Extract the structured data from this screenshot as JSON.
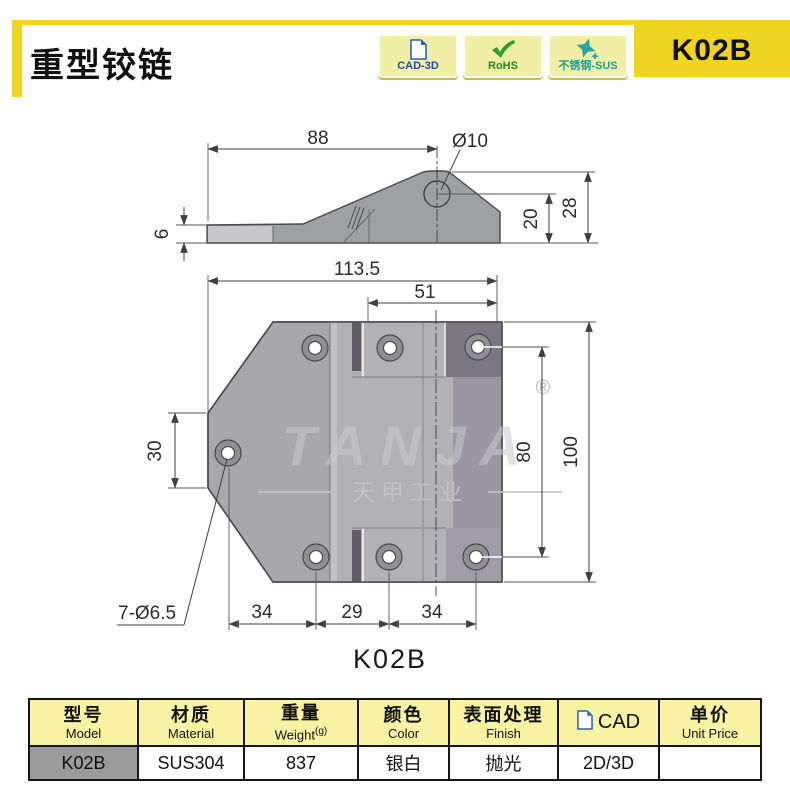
{
  "header": {
    "title": "重型铰链",
    "model_code": "K02B",
    "accent_yellow": "#f0d520",
    "badges": [
      {
        "label": "CAD-3D",
        "icon": "cad-document-icon",
        "color": "#1a4e9e"
      },
      {
        "label": "RoHS",
        "icon": "check-icon",
        "color": "#1e8c28"
      },
      {
        "label": "不锈钢-SUS",
        "icon": "sparkle-star-icon",
        "color": "#18a098"
      }
    ]
  },
  "drawing": {
    "side_view": {
      "length": "88",
      "hole_dia": "Ø10",
      "thickness": "6",
      "hole_center_height": "20",
      "total_height": "28"
    },
    "front_view": {
      "overall_width": "113.5",
      "leaf_width": "51",
      "left_edge_height": "30",
      "hole_span": "80",
      "overall_height": "100",
      "pitch_a": "34",
      "pitch_b": "29",
      "pitch_c": "34",
      "holes_note": "7-Ø6.5"
    },
    "watermark": {
      "brand": "TANJA",
      "company": "天甲工业",
      "registered": "®"
    },
    "caption": "K02B"
  },
  "table": {
    "headers": [
      {
        "zh": "型号",
        "en": "Model"
      },
      {
        "zh": "材质",
        "en": "Material"
      },
      {
        "zh": "重量",
        "en": "Weight",
        "en_sup": "(g)"
      },
      {
        "zh": "颜色",
        "en": "Color"
      },
      {
        "zh": "表面处理",
        "en": "Finish"
      },
      {
        "zh": "CAD",
        "en": ""
      },
      {
        "zh": "单价",
        "en": "Unit Price"
      }
    ],
    "row": {
      "model": "K02B",
      "material": "SUS304",
      "weight": "837",
      "color": "银白",
      "finish": "抛光",
      "cad": "2D/3D",
      "unit_price": ""
    }
  }
}
